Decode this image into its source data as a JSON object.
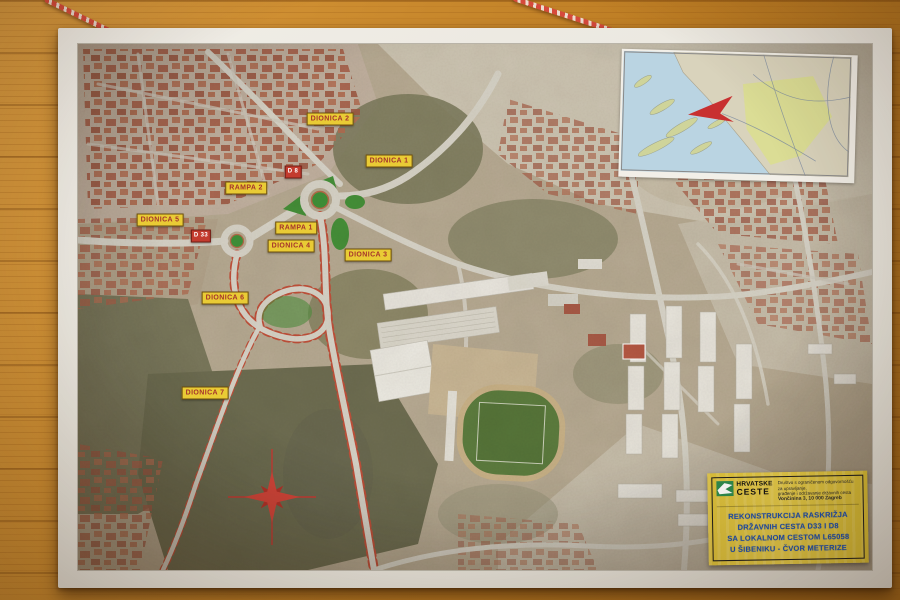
{
  "map_labels": [
    {
      "id": "dionica-2",
      "text": "DIONICA 2",
      "style": "yellow"
    },
    {
      "id": "dionica-1",
      "text": "DIONICA 1",
      "style": "yellow"
    },
    {
      "id": "rampa-2",
      "text": "RAMPA 2",
      "style": "yellow"
    },
    {
      "id": "d8",
      "text": "D 8",
      "style": "red"
    },
    {
      "id": "dionica-5",
      "text": "DIONICA 5",
      "style": "yellow"
    },
    {
      "id": "d33",
      "text": "D 33",
      "style": "red"
    },
    {
      "id": "rampa-1",
      "text": "RAMPA 1",
      "style": "yellow"
    },
    {
      "id": "dionica-4",
      "text": "DIONICA 4",
      "style": "yellow"
    },
    {
      "id": "dionica-3",
      "text": "DIONICA 3",
      "style": "yellow"
    },
    {
      "id": "dionica-6",
      "text": "DIONICA 6",
      "style": "yellow"
    },
    {
      "id": "dionica-7",
      "text": "DIONICA 7",
      "style": "yellow"
    }
  ],
  "title_block": {
    "org_name_top": "HRVATSKE",
    "org_name_bottom": "CESTE",
    "org_desc_line1": "Društvo s ograničenom odgovornošću za upravljanje,",
    "org_desc_line2": "građenje i održavanje državnih cesta",
    "org_address": "Vončinina 3, 10 000 Zagreb",
    "title_line1": "REKONSTRUKCIJA RASKRIŽJA",
    "title_line2": "DRŽAVNIH CESTA D33 I D8",
    "title_line3": "SA LOKALNOM CESTOM L65058",
    "title_line4": "U ŠIBENIKU - ČVOR METERIZE"
  },
  "colors": {
    "label_yellow": "#e9cb35",
    "label_text_red": "#a5342c",
    "road_badge_red": "#c33b2e",
    "title_blue": "#1d4fb0",
    "logo_green": "#2e8b4f",
    "roundabout_green": "#3f9138",
    "construction_red": "#c0503a",
    "wood": "#c08324"
  }
}
